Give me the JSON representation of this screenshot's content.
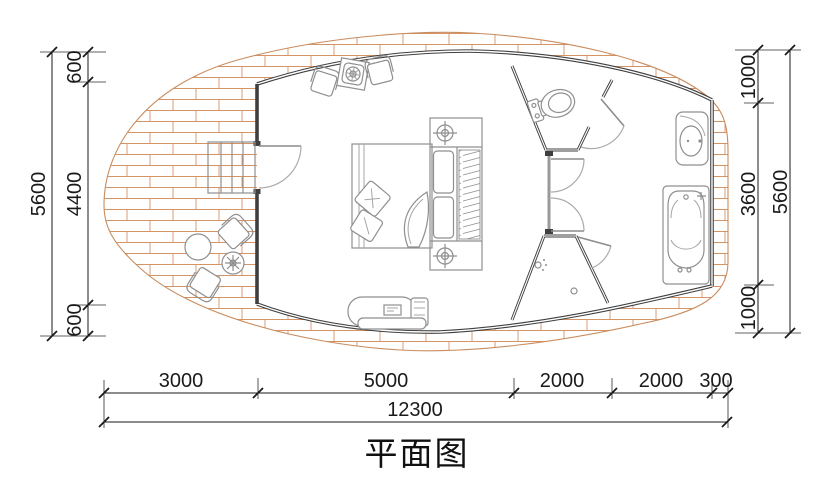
{
  "title": "平面图",
  "colors": {
    "brick": "#d49465",
    "wall": "#3f3f3f",
    "furniture": "#8f8f8f",
    "dim": "#1a1a1a"
  },
  "dimensions": {
    "left": {
      "segments": [
        "600",
        "4400",
        "600"
      ],
      "total": "5600"
    },
    "right": {
      "segments": [
        "1000",
        "3600",
        "1000"
      ],
      "total": "5600"
    },
    "bottom": {
      "segments": [
        "3000",
        "5000",
        "2000",
        "2000",
        "300"
      ],
      "total": "12300"
    }
  }
}
